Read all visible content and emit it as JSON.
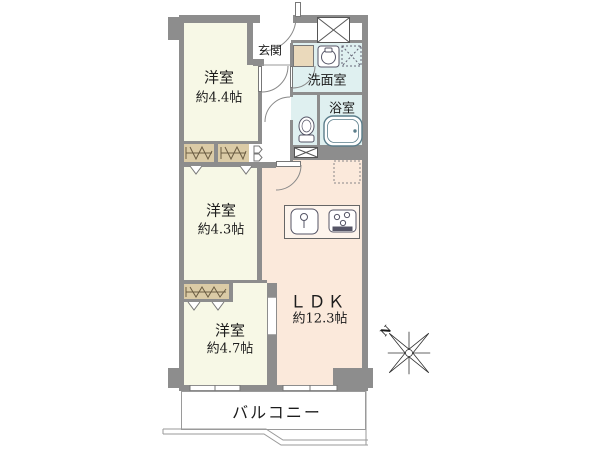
{
  "plan": {
    "type": "apartment-floor-plan",
    "rooms": {
      "genkan": {
        "name": "玄関"
      },
      "senmen": {
        "name": "洗面室"
      },
      "yokushitsu": {
        "name": "浴室"
      },
      "yoshitsu44": {
        "name": "洋室",
        "area": "約4.4帖"
      },
      "yoshitsu43": {
        "name": "洋室",
        "area": "約4.3帖"
      },
      "yoshitsu47": {
        "name": "洋室",
        "area": "約4.7帖"
      },
      "ldk": {
        "name": "ＬＤＫ",
        "area": "約12.3帖"
      },
      "balcony": {
        "name": "バルコニー"
      }
    },
    "compass": {
      "label": "N",
      "direction": "upper-left"
    },
    "icons": [
      "toilet-icon",
      "bathtub-icon",
      "washbasin-icon",
      "washer-space-icon",
      "kitchen-sink-icon",
      "stove-icon",
      "fridge-space-icon",
      "pipe-space-icon",
      "closet-hanger-icon",
      "door-swing-icon",
      "compass-rose-icon"
    ],
    "colors": {
      "wall": "#8d8d8d",
      "western_room": "#f7f8e6",
      "ldk": "#fbe9db",
      "wet_area": "#dff0f0",
      "closet": "#dbcba6",
      "line": "#555555"
    }
  }
}
